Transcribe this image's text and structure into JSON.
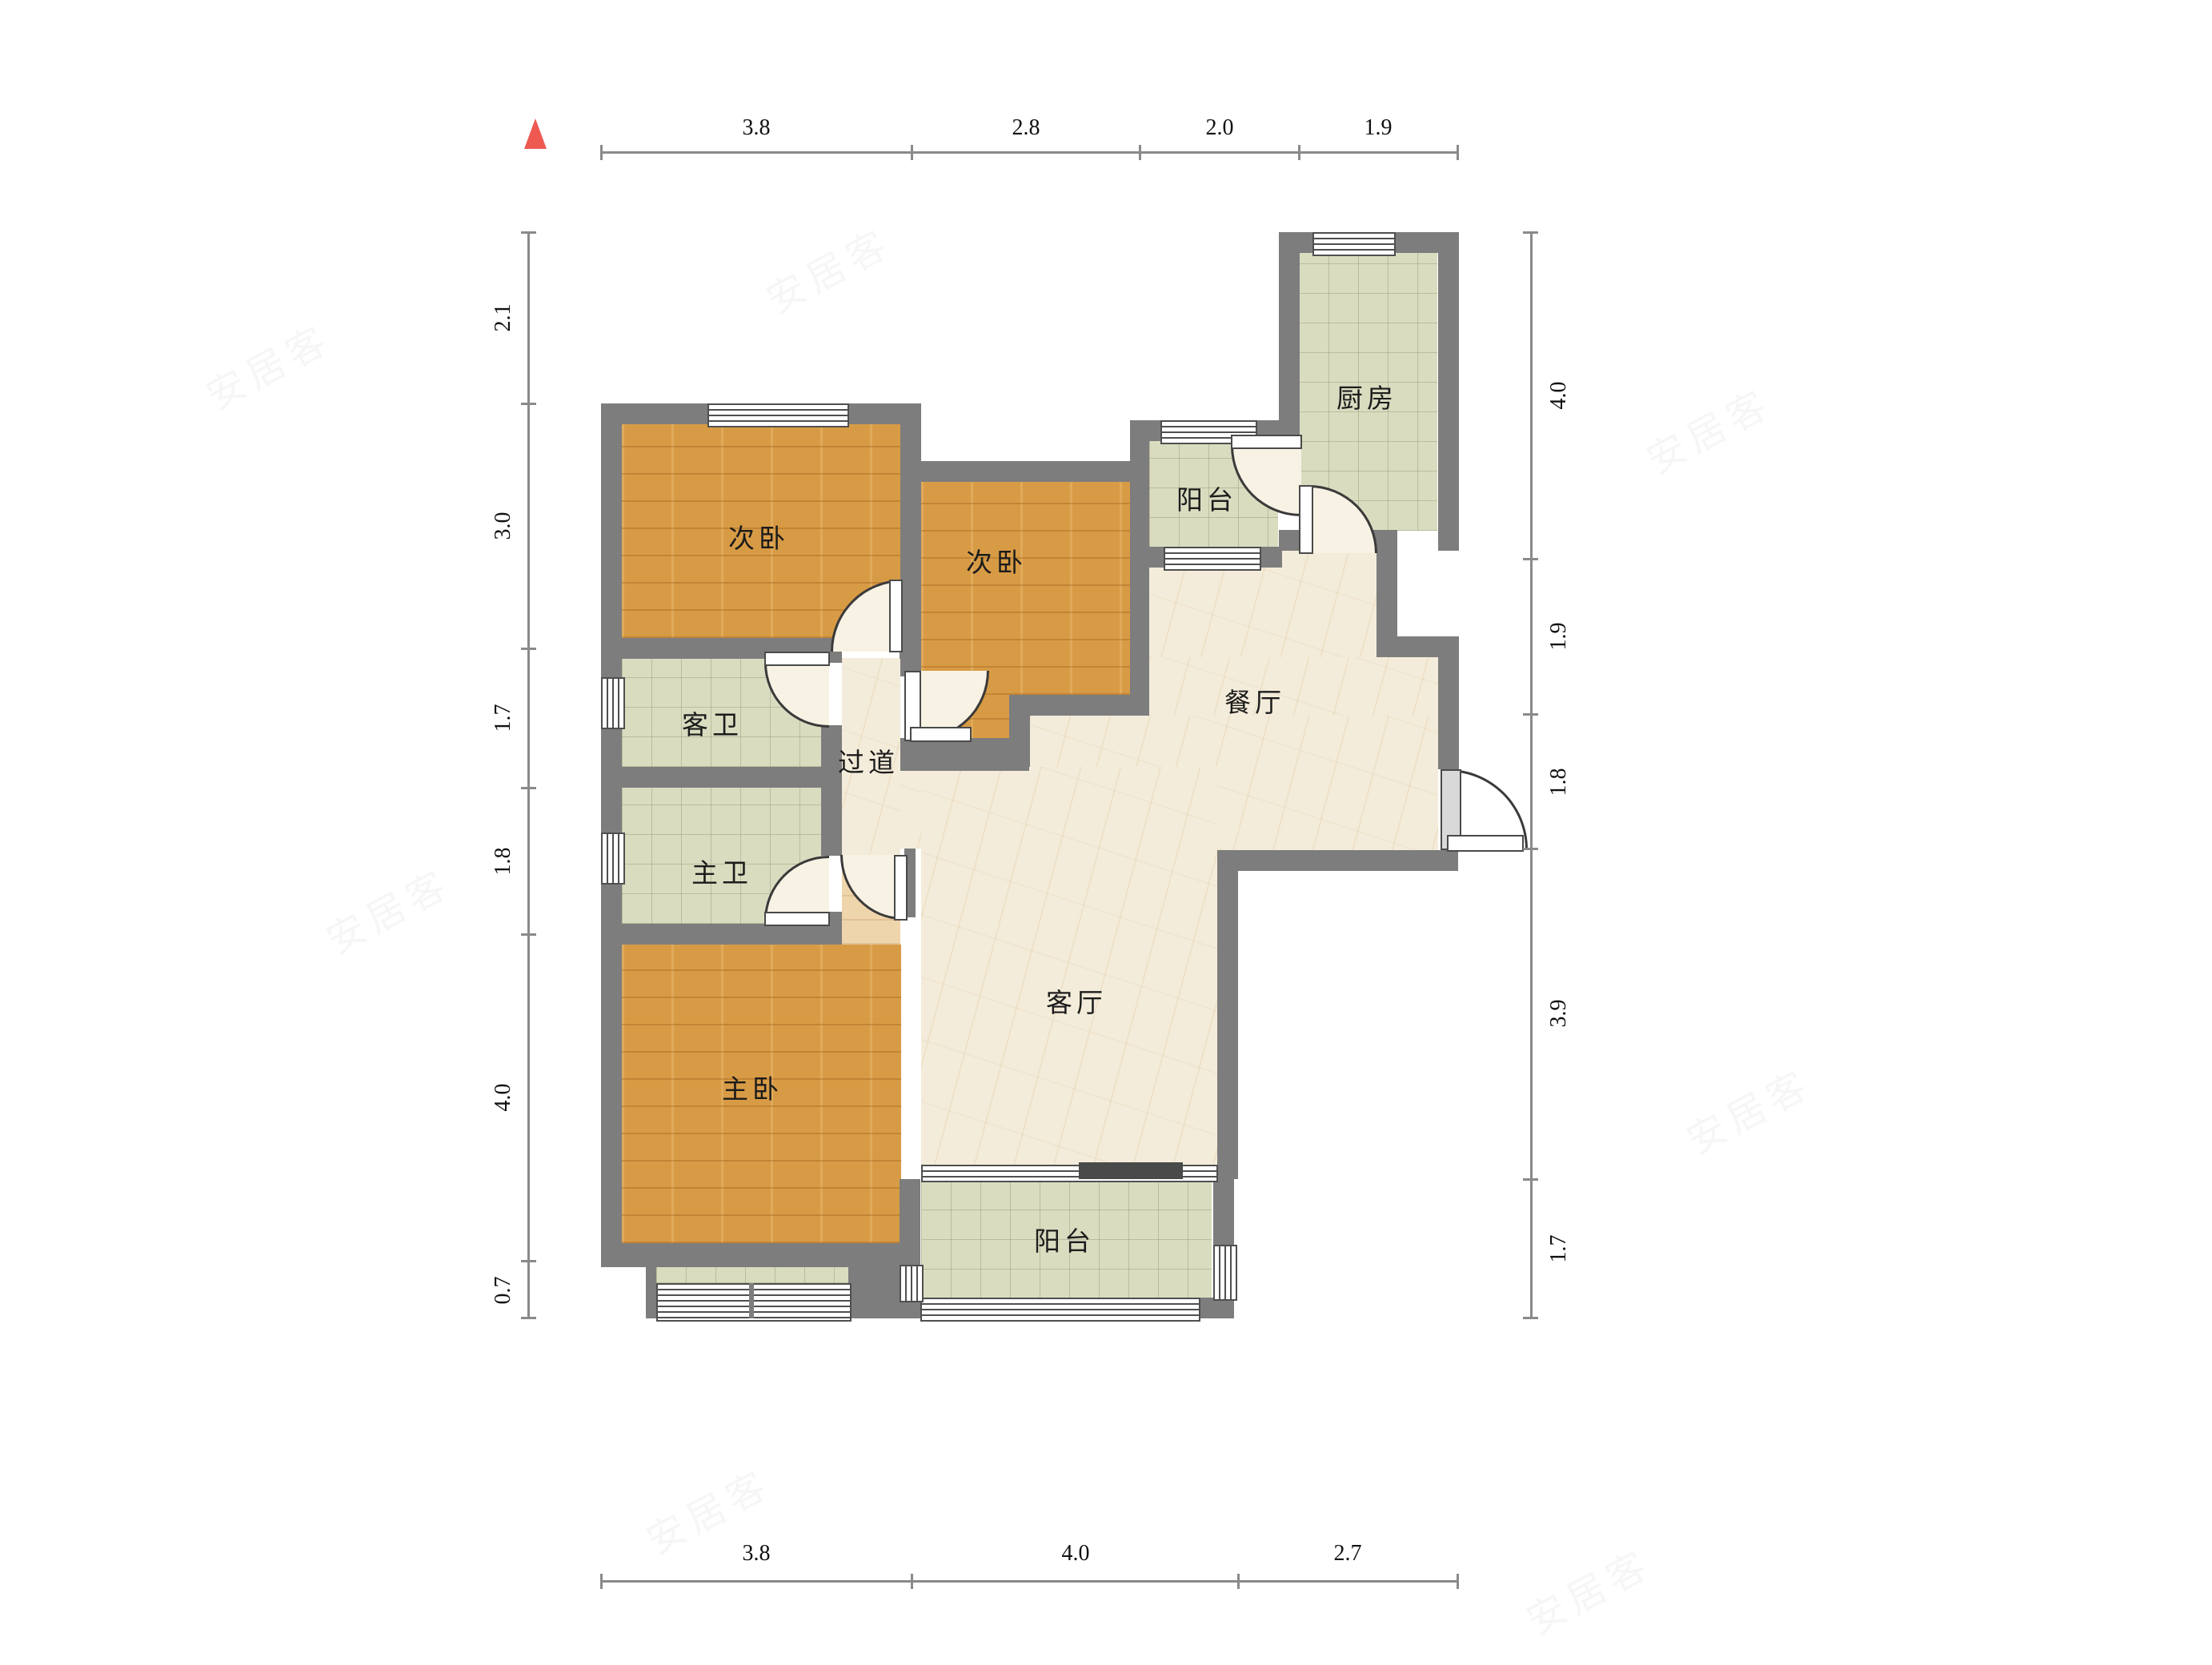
{
  "watermark": {
    "text": "安居客"
  },
  "north_indicator": {
    "icon": "north-arrow-icon",
    "color": "#ee5a52"
  },
  "rooms": [
    {
      "id": "bedroom-second-left",
      "label": "次卧"
    },
    {
      "id": "bedroom-second-mid",
      "label": "次卧"
    },
    {
      "id": "guest-bathroom",
      "label": "客卫"
    },
    {
      "id": "master-bathroom",
      "label": "主卫"
    },
    {
      "id": "master-bedroom",
      "label": "主卧"
    },
    {
      "id": "hallway",
      "label": "过道"
    },
    {
      "id": "dining-room",
      "label": "餐厅"
    },
    {
      "id": "living-room",
      "label": "客厅"
    },
    {
      "id": "kitchen",
      "label": "厨房"
    },
    {
      "id": "balcony-top",
      "label": "阳台"
    },
    {
      "id": "balcony-bottom",
      "label": "阳台"
    }
  ],
  "dimensions": {
    "top": [
      "3.8",
      "2.8",
      "2.0",
      "1.9"
    ],
    "left": [
      "2.1",
      "3.0",
      "1.7",
      "1.8",
      "4.0",
      "0.7"
    ],
    "right": [
      "4.0",
      "1.9",
      "1.8",
      "3.9",
      "1.7"
    ],
    "bottom": [
      "3.8",
      "4.0",
      "2.7"
    ]
  },
  "colors": {
    "wall": "#7d7d7d",
    "wood_floor": "#d89b45",
    "tile_floor": "#dadcc0",
    "marble_floor": "#f4ecda",
    "door_arc": "#3a3a3a",
    "dimension_line": "#8a8a8a",
    "north_arrow": "#ee5a52"
  }
}
